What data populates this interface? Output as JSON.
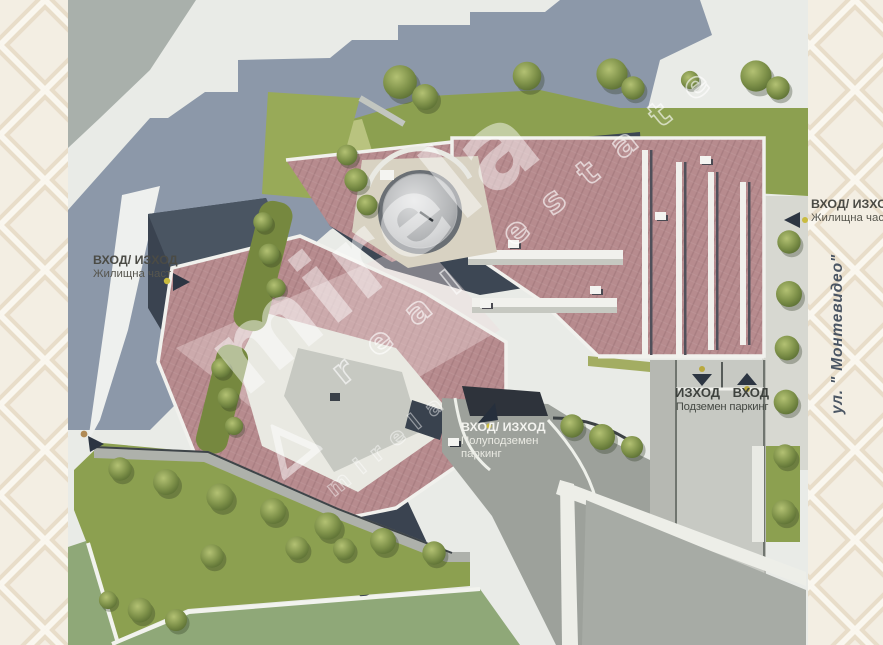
{
  "watermark": {
    "brand": "mirela",
    "tagline": "real estate"
  },
  "labels": {
    "residential_left": {
      "title": "ВХОД/ ИЗХОД",
      "subtitle": "Жилищна част"
    },
    "residential_right": {
      "title": "ВХОД/ ИЗХОД",
      "subtitle": "Жилищна част"
    },
    "street": "ул. \" Монтевидео\"",
    "semi_underground": {
      "title": "ВХОД/ ИЗХОД",
      "line2": "Полуподземен",
      "line3": "паркинг"
    },
    "underground": {
      "exit": "ИЗХОД",
      "entrance": "ВХОД",
      "caption": "Подземен паркинг"
    }
  },
  "colors": {
    "background": "#f2ecdf",
    "pattern_line": "#e8ddc9",
    "roof": "#b78b8e",
    "lawn": "#8ca050",
    "flat_lawn": "#8fa878",
    "shadow": "#8c98a9",
    "walls": "#3a4350",
    "courtyard": "#3d4754",
    "pavement": "#e9ebe7",
    "road": "#9da19b",
    "concrete": "#c7c9c3",
    "plaza": "#d8d2c2",
    "dome": "#aeb0b2",
    "marker": "#2c3542",
    "marker_dot": "#c9bb3f",
    "label_dark": "#4b4b45",
    "label_white": "#f3f3ef",
    "street_text": "#4a5563"
  }
}
